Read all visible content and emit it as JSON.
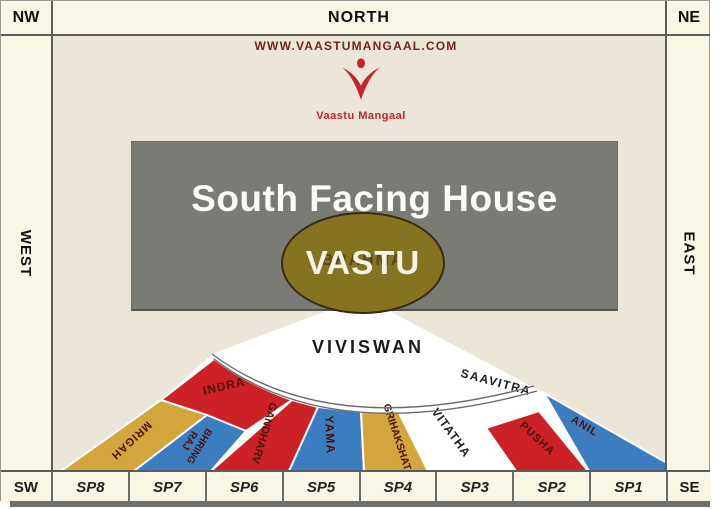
{
  "frame": {
    "nw": "NW",
    "north": "NORTH",
    "ne": "NE",
    "west": "WEST",
    "east": "EAST",
    "sw": "SW",
    "se": "SE",
    "sp_cells": [
      "SP8",
      "SP7",
      "SP6",
      "SP5",
      "SP4",
      "SP3",
      "SP2",
      "SP1"
    ]
  },
  "header": {
    "website": "WWW.VAASTUMANGAAL.COM",
    "logo_caption": "Vaastu Mangaal"
  },
  "title_box": {
    "title": "South Facing House",
    "oval_label": "VASTU",
    "oval_back_label": "BRAHMA"
  },
  "fan": {
    "center_sector_label": "VIVISWAN",
    "segments": [
      {
        "label": "INDRA",
        "color_key": "red"
      },
      {
        "label": "MRIGAH",
        "color_key": "gold"
      },
      {
        "label": "BHRING RAJ",
        "color_key": "blue",
        "lines": [
          "BHRING",
          "RAJ"
        ]
      },
      {
        "label": "GANDHARV",
        "color_key": "red"
      },
      {
        "label": "YAMA",
        "color_key": "blue"
      },
      {
        "label": "GRIHAKSHAT",
        "color_key": "gold"
      },
      {
        "label": "VITATHA",
        "color_key": "white"
      },
      {
        "label": "SAAVITRA",
        "color_key": "white"
      },
      {
        "label": "PUSHA",
        "color_key": "red"
      },
      {
        "label": "ANIL",
        "color_key": "blue"
      }
    ]
  },
  "colors": {
    "red": "#cd2128",
    "blue": "#3c7dc0",
    "gold": "#d2a63d",
    "white_fan": "#ffffff",
    "cream_frame": "#faf6e6",
    "cream_inner": "#ebe6d7",
    "gray_box": "#7b7b76",
    "oval_fill": "#867322",
    "logo_red": "#c1272d",
    "url_maroon": "#72241b",
    "label_dark": "#4a120c",
    "label_black": "#1c1c1c",
    "line_gray": "#6b6b6b"
  }
}
